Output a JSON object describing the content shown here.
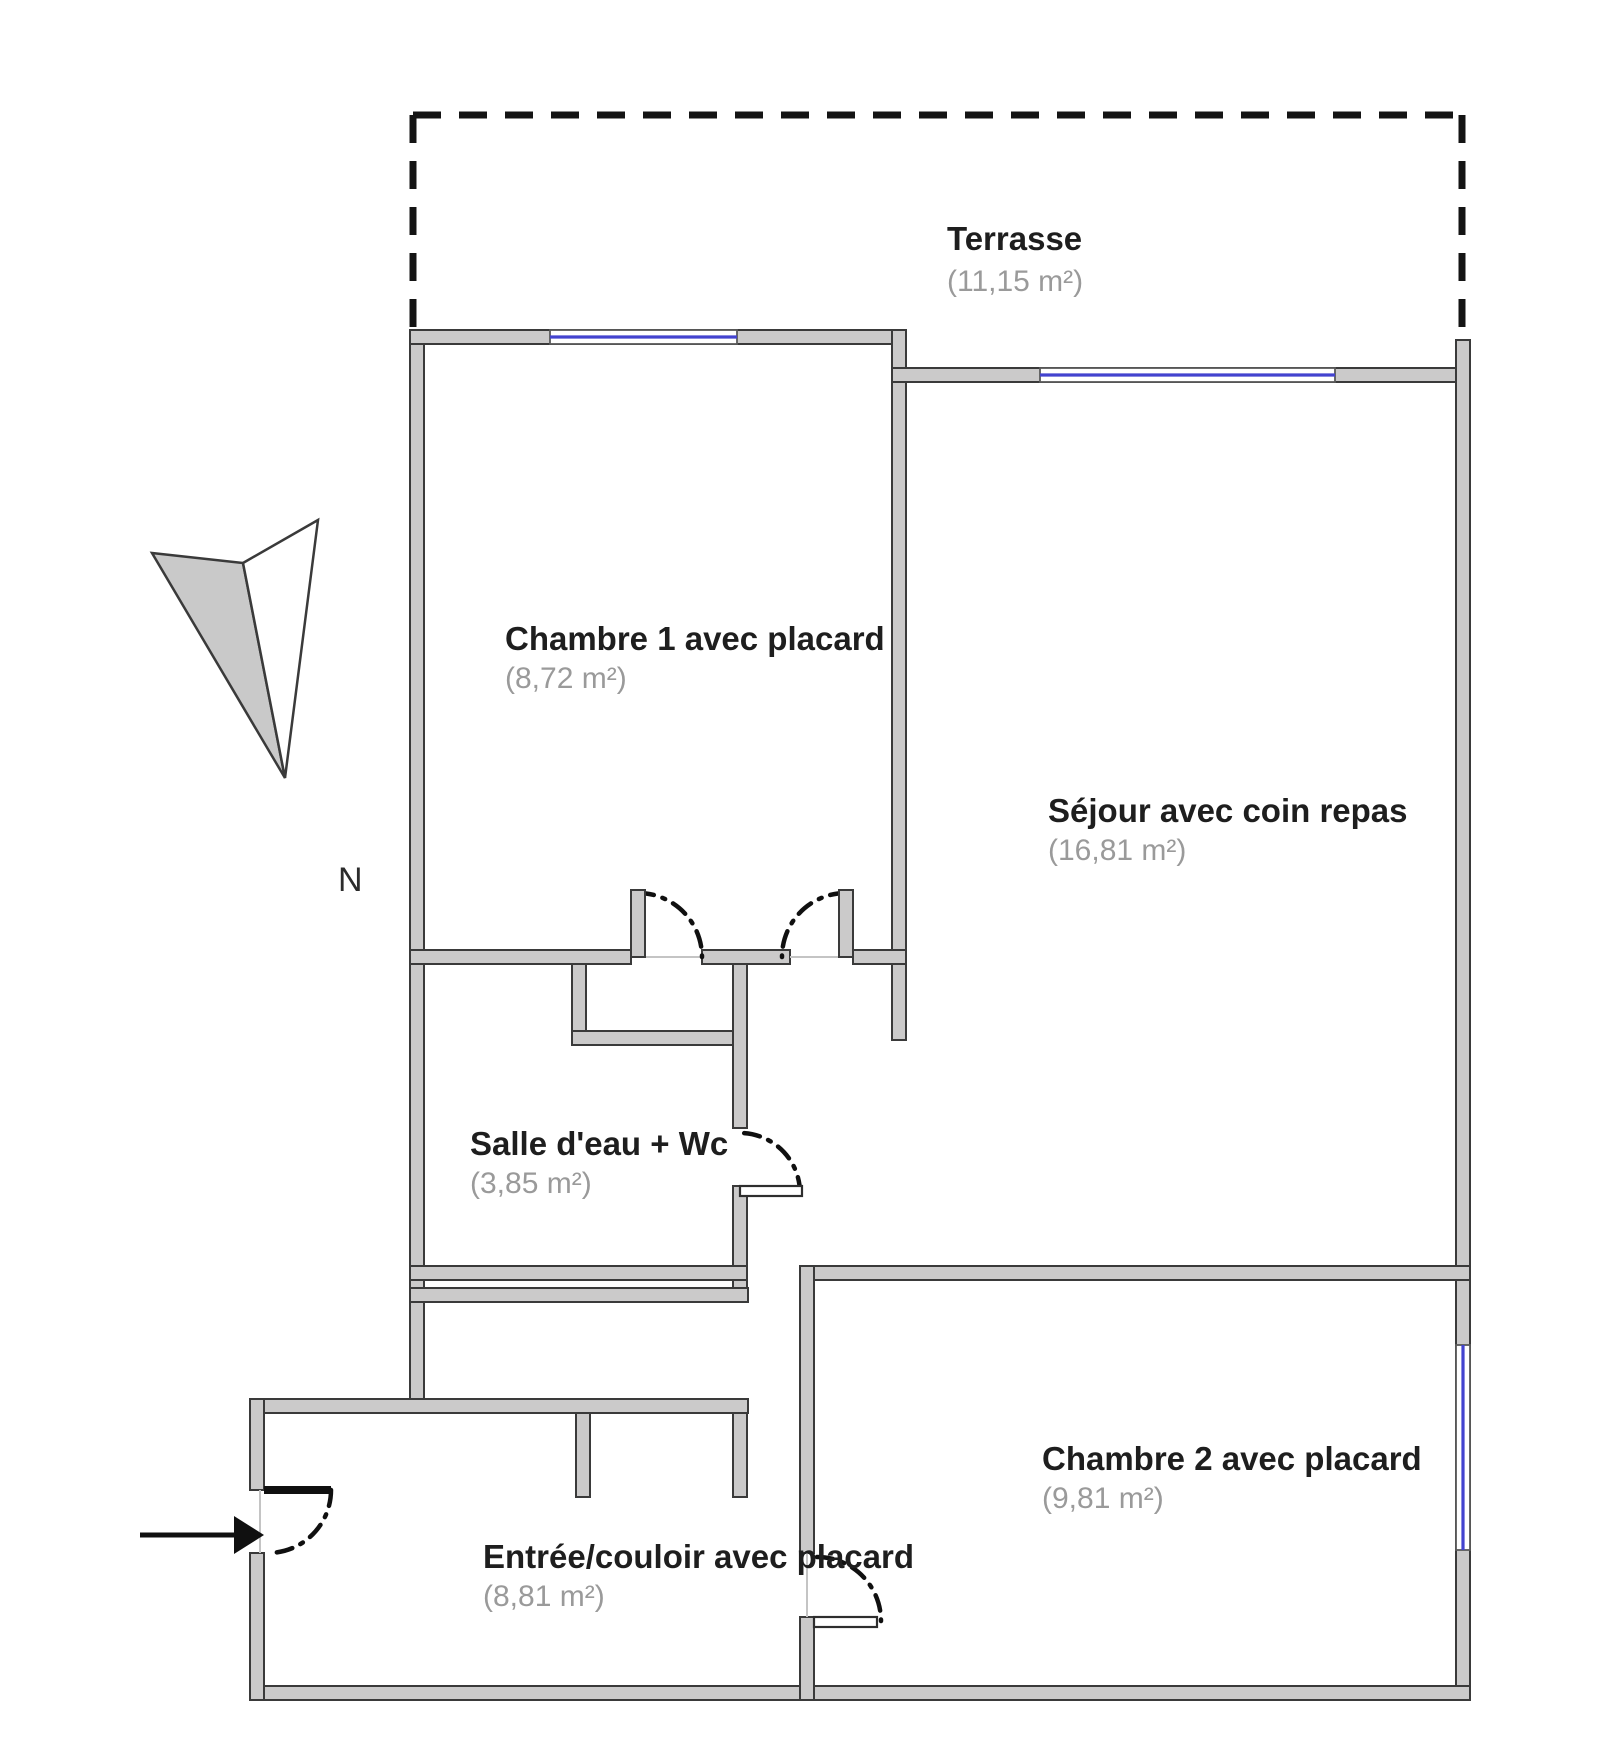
{
  "meta": {
    "type": "apartment-floor-plan"
  },
  "colors": {
    "wall_fill": "#cbcaca",
    "wall_stroke": "#3a3a3a",
    "window_blue": "#4343cf",
    "dash_color": "#141414",
    "door_color": "#101010",
    "label_color": "#1e1e1e",
    "area_color": "#9a9a9a"
  },
  "compass": {
    "label": "N",
    "label_pos": [
      338,
      891
    ],
    "needle": [
      {
        "points": "152,553 243,563 285,778",
        "fill": "#c9c9c9"
      },
      {
        "points": "243,563 318,520 285,778",
        "fill": "#ffffff"
      }
    ]
  },
  "entrance_arrow": {
    "line": [
      140,
      1535,
      234,
      1535
    ],
    "head": "234,1516 264,1535 234,1554"
  },
  "rooms": [
    {
      "id": "terrasse",
      "name": "Terrasse",
      "area": "(11,15 m²)",
      "name_pos": [
        947,
        250
      ],
      "area_pos": [
        947,
        291
      ]
    },
    {
      "id": "chambre1",
      "name": "Chambre 1 avec placard",
      "area": "(8,72 m²)",
      "name_pos": [
        505,
        650
      ],
      "area_pos": [
        505,
        688
      ]
    },
    {
      "id": "sejour",
      "name": "Séjour avec coin repas",
      "area": "(16,81 m²)",
      "name_pos": [
        1048,
        822
      ],
      "area_pos": [
        1048,
        860
      ]
    },
    {
      "id": "salle_eau",
      "name": "Salle d'eau + Wc",
      "area": "(3,85 m²)",
      "name_pos": [
        470,
        1155
      ],
      "area_pos": [
        470,
        1193
      ]
    },
    {
      "id": "chambre2",
      "name": "Chambre 2 avec placard",
      "area": "(9,81 m²)",
      "name_pos": [
        1042,
        1470
      ],
      "area_pos": [
        1042,
        1508
      ]
    },
    {
      "id": "entree",
      "name": "Entrée/couloir avec placard",
      "area": "(8,81 m²)",
      "name_pos": [
        483,
        1568
      ],
      "area_pos": [
        483,
        1606
      ]
    }
  ],
  "plan": {
    "width": 1600,
    "height": 1747,
    "dashed_lines": [
      [
        413,
        115,
        1462,
        115
      ],
      [
        413,
        115,
        413,
        332
      ],
      [
        1462,
        115,
        1462,
        355
      ]
    ],
    "walls": [
      [
        410,
        330,
        14,
        1083
      ],
      [
        410,
        330,
        496,
        14
      ],
      [
        892,
        330,
        14,
        710
      ],
      [
        892,
        368,
        578,
        14
      ],
      [
        1456,
        340,
        14,
        1360
      ],
      [
        250,
        1686,
        1220,
        14
      ],
      [
        250,
        1399,
        498,
        14
      ],
      [
        250,
        1399,
        14,
        91
      ],
      [
        250,
        1553,
        14,
        147
      ],
      [
        410,
        950,
        221,
        14
      ],
      [
        702,
        950,
        88,
        14
      ],
      [
        853,
        950,
        53,
        14
      ],
      [
        572,
        964,
        14,
        81
      ],
      [
        572,
        1031,
        175,
        14
      ],
      [
        733,
        964,
        14,
        164
      ],
      [
        733,
        1186,
        14,
        116
      ],
      [
        410,
        1266,
        337,
        14
      ],
      [
        410,
        1288,
        338,
        14
      ],
      [
        800,
        1266,
        670,
        14
      ],
      [
        800,
        1266,
        14,
        287
      ],
      [
        800,
        1617,
        14,
        83
      ],
      [
        576,
        1413,
        14,
        84
      ],
      [
        733,
        1413,
        14,
        84
      ]
    ],
    "windows": [
      {
        "rect": [
          550,
          330,
          187,
          14
        ],
        "line": [
          550,
          337,
          737,
          337
        ]
      },
      {
        "rect": [
          1040,
          368,
          295,
          14
        ],
        "line": [
          1040,
          375,
          1335,
          375
        ]
      },
      {
        "rect": [
          1456,
          1345,
          14,
          205
        ],
        "line": [
          1463,
          1345,
          1463,
          1550
        ]
      }
    ],
    "doors": [
      {
        "id": "door-chambre1-placard",
        "path": "M638,893 A64,64 0 0 1 702,957",
        "leaf": [
          631,
          890,
          14,
          67
        ],
        "leaf_style": "wall",
        "open_line": [
          645,
          957,
          702,
          957
        ]
      },
      {
        "id": "door-chambre1",
        "path": "M846,893 A64,64 0 0 0 782,957",
        "leaf": [
          839,
          890,
          14,
          67
        ],
        "leaf_style": "wall",
        "open_line": [
          790,
          957,
          839,
          957
        ]
      },
      {
        "id": "door-salle-eau",
        "path": "M800,1193 A60,60 0 0 0 740,1133",
        "leaf": [
          740,
          1186,
          62,
          10
        ],
        "leaf_style": "thin",
        "open_line": null
      },
      {
        "id": "door-entree",
        "path": "M331,1490 A63,63 0 0 1 268,1553",
        "leaf": [
          264,
          1486,
          67,
          8
        ],
        "leaf_style": "solid",
        "open_line": [
          260,
          1490,
          260,
          1553
        ]
      },
      {
        "id": "door-chambre2",
        "path": "M817,1557 A64,64 0 0 1 881,1621",
        "leaf": [
          814,
          1617,
          63,
          10
        ],
        "leaf_style": "thin",
        "open_line": [
          807,
          1553,
          807,
          1617
        ]
      }
    ]
  }
}
